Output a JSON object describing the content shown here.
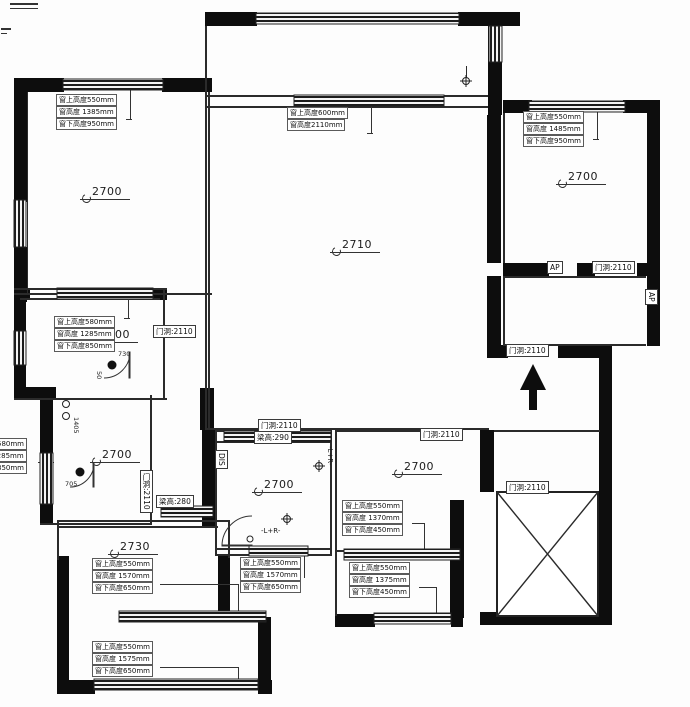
{
  "drawing": {
    "type": "residential-floor-plan",
    "wall_color": "#0d0d0d",
    "line_color": "#2b2b2b",
    "background": "#fdfdfd"
  },
  "rooms": {
    "tl": {
      "height": "2700"
    },
    "living": {
      "height": "2710"
    },
    "tr": {
      "height": "2700"
    },
    "ml": {
      "height": "2700"
    },
    "ll": {
      "height": "2700"
    },
    "bl": {
      "height": "2730"
    },
    "bath": {
      "height": "2700"
    },
    "bm": {
      "height": "2700"
    }
  },
  "labels": {
    "tl": {
      "l1": "窗上高度550mm",
      "l2": "窗高度 1385mm",
      "l3": "窗下高度950mm"
    },
    "c": {
      "l1": "窗上高度600mm",
      "l2": "窗高度2110mm"
    },
    "tr": {
      "l1": "窗上高度550mm",
      "l2": "窗高度 1485mm",
      "l3": "窗下高度950mm"
    },
    "ml": {
      "l1": "窗上高度580mm",
      "l2": "窗高度 1285mm",
      "l3": "窗下高度850mm"
    },
    "ll": {
      "l1": "窗上高度580mm",
      "l2": "窗高度 1285mm",
      "l3": "窗下高度850mm"
    },
    "bl1": {
      "l1": "窗上高度550mm",
      "l2": "窗高度 1570mm",
      "l3": "窗下高度650mm"
    },
    "bl2": {
      "l1": "窗上高度550mm",
      "l2": "窗高度 1575mm",
      "l3": "窗下高度650mm"
    },
    "bc": {
      "l1": "窗上高度550mm",
      "l2": "窗高度 1570mm",
      "l3": "窗下高度650mm"
    },
    "bm1": {
      "l1": "窗上高度550mm",
      "l2": "窗高度 1370mm",
      "l3": "窗下高度450mm"
    },
    "bm2": {
      "l1": "窗上高度550mm",
      "l2": "窗高度 1375mm",
      "l3": "窗下高度450mm"
    }
  },
  "doors": {
    "opening": "门洞:2110",
    "beam290": "梁高:290",
    "beam280": "梁高:280",
    "ap": "AP",
    "dis": "DIS"
  },
  "symbols": {
    "lamp_side": "-L+R-",
    "lamp_bottom": "-L+R-"
  },
  "dims": {
    "d1405": "1405",
    "d730": "730",
    "d50": "50",
    "d705": "705"
  }
}
